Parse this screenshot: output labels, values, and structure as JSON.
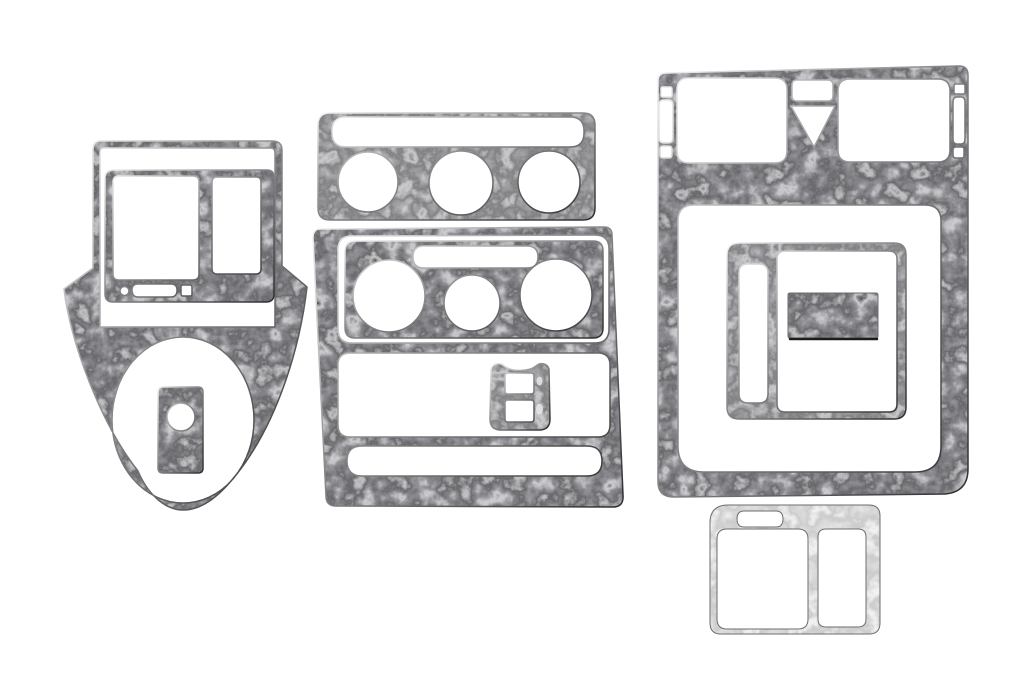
{
  "scene": {
    "description": "Product photo of an eleven-piece dark burl wood dash trim kit with chrome edges laid out on a white background",
    "background_color": "#ffffff"
  },
  "palette": {
    "burl_darkest": "#151517",
    "burl_dark": "#2b2b2d",
    "burl_mid": "#6e6e70",
    "burl_swirl_light": "#a8a8aa",
    "chrome_edge_light": "#f2f2f2",
    "chrome_edge_dark": "#2e2e30",
    "silver_piece": "#9c9c9e",
    "background": "#ffffff"
  },
  "pieces": [
    {
      "id": "console-shifter-frame",
      "label": "Console frame with two-window bezel opening and large oval shifter opening",
      "finish": "dark-burl"
    },
    {
      "id": "radio-bezel",
      "label": "Radio bezel insert with square window, tall window, round hole and slot",
      "finish": "dark-burl"
    },
    {
      "id": "shifter-plate",
      "label": "Small rectangular plate with round hole",
      "finish": "dark-burl"
    },
    {
      "id": "vent-strip",
      "label": "Vent strip with long slot and three round openings",
      "finish": "dark-burl"
    },
    {
      "id": "center-stack-panel",
      "label": "Center stack panel with three cutout windows",
      "finish": "dark-burl"
    },
    {
      "id": "gauge-bezel",
      "label": "Climate control bezel with slot and three round openings",
      "finish": "dark-burl"
    },
    {
      "id": "switch-plate",
      "label": "Window switch plate with two rectangular holes",
      "finish": "dark-burl"
    },
    {
      "id": "upper-dash-panel",
      "label": "Upper dash panel with two vent windows, hazard triangle cutout, side slots and large lower window",
      "finish": "dark-burl"
    },
    {
      "id": "console-inner-frame",
      "label": "Inner console frame with tall slot and large window",
      "finish": "dark-burl"
    },
    {
      "id": "blank-plate",
      "label": "Rectangular blank plate",
      "finish": "dark-burl"
    },
    {
      "id": "lower-switch-panel",
      "label": "Lower switch panel with slot and two windows",
      "finish": "silver"
    }
  ]
}
